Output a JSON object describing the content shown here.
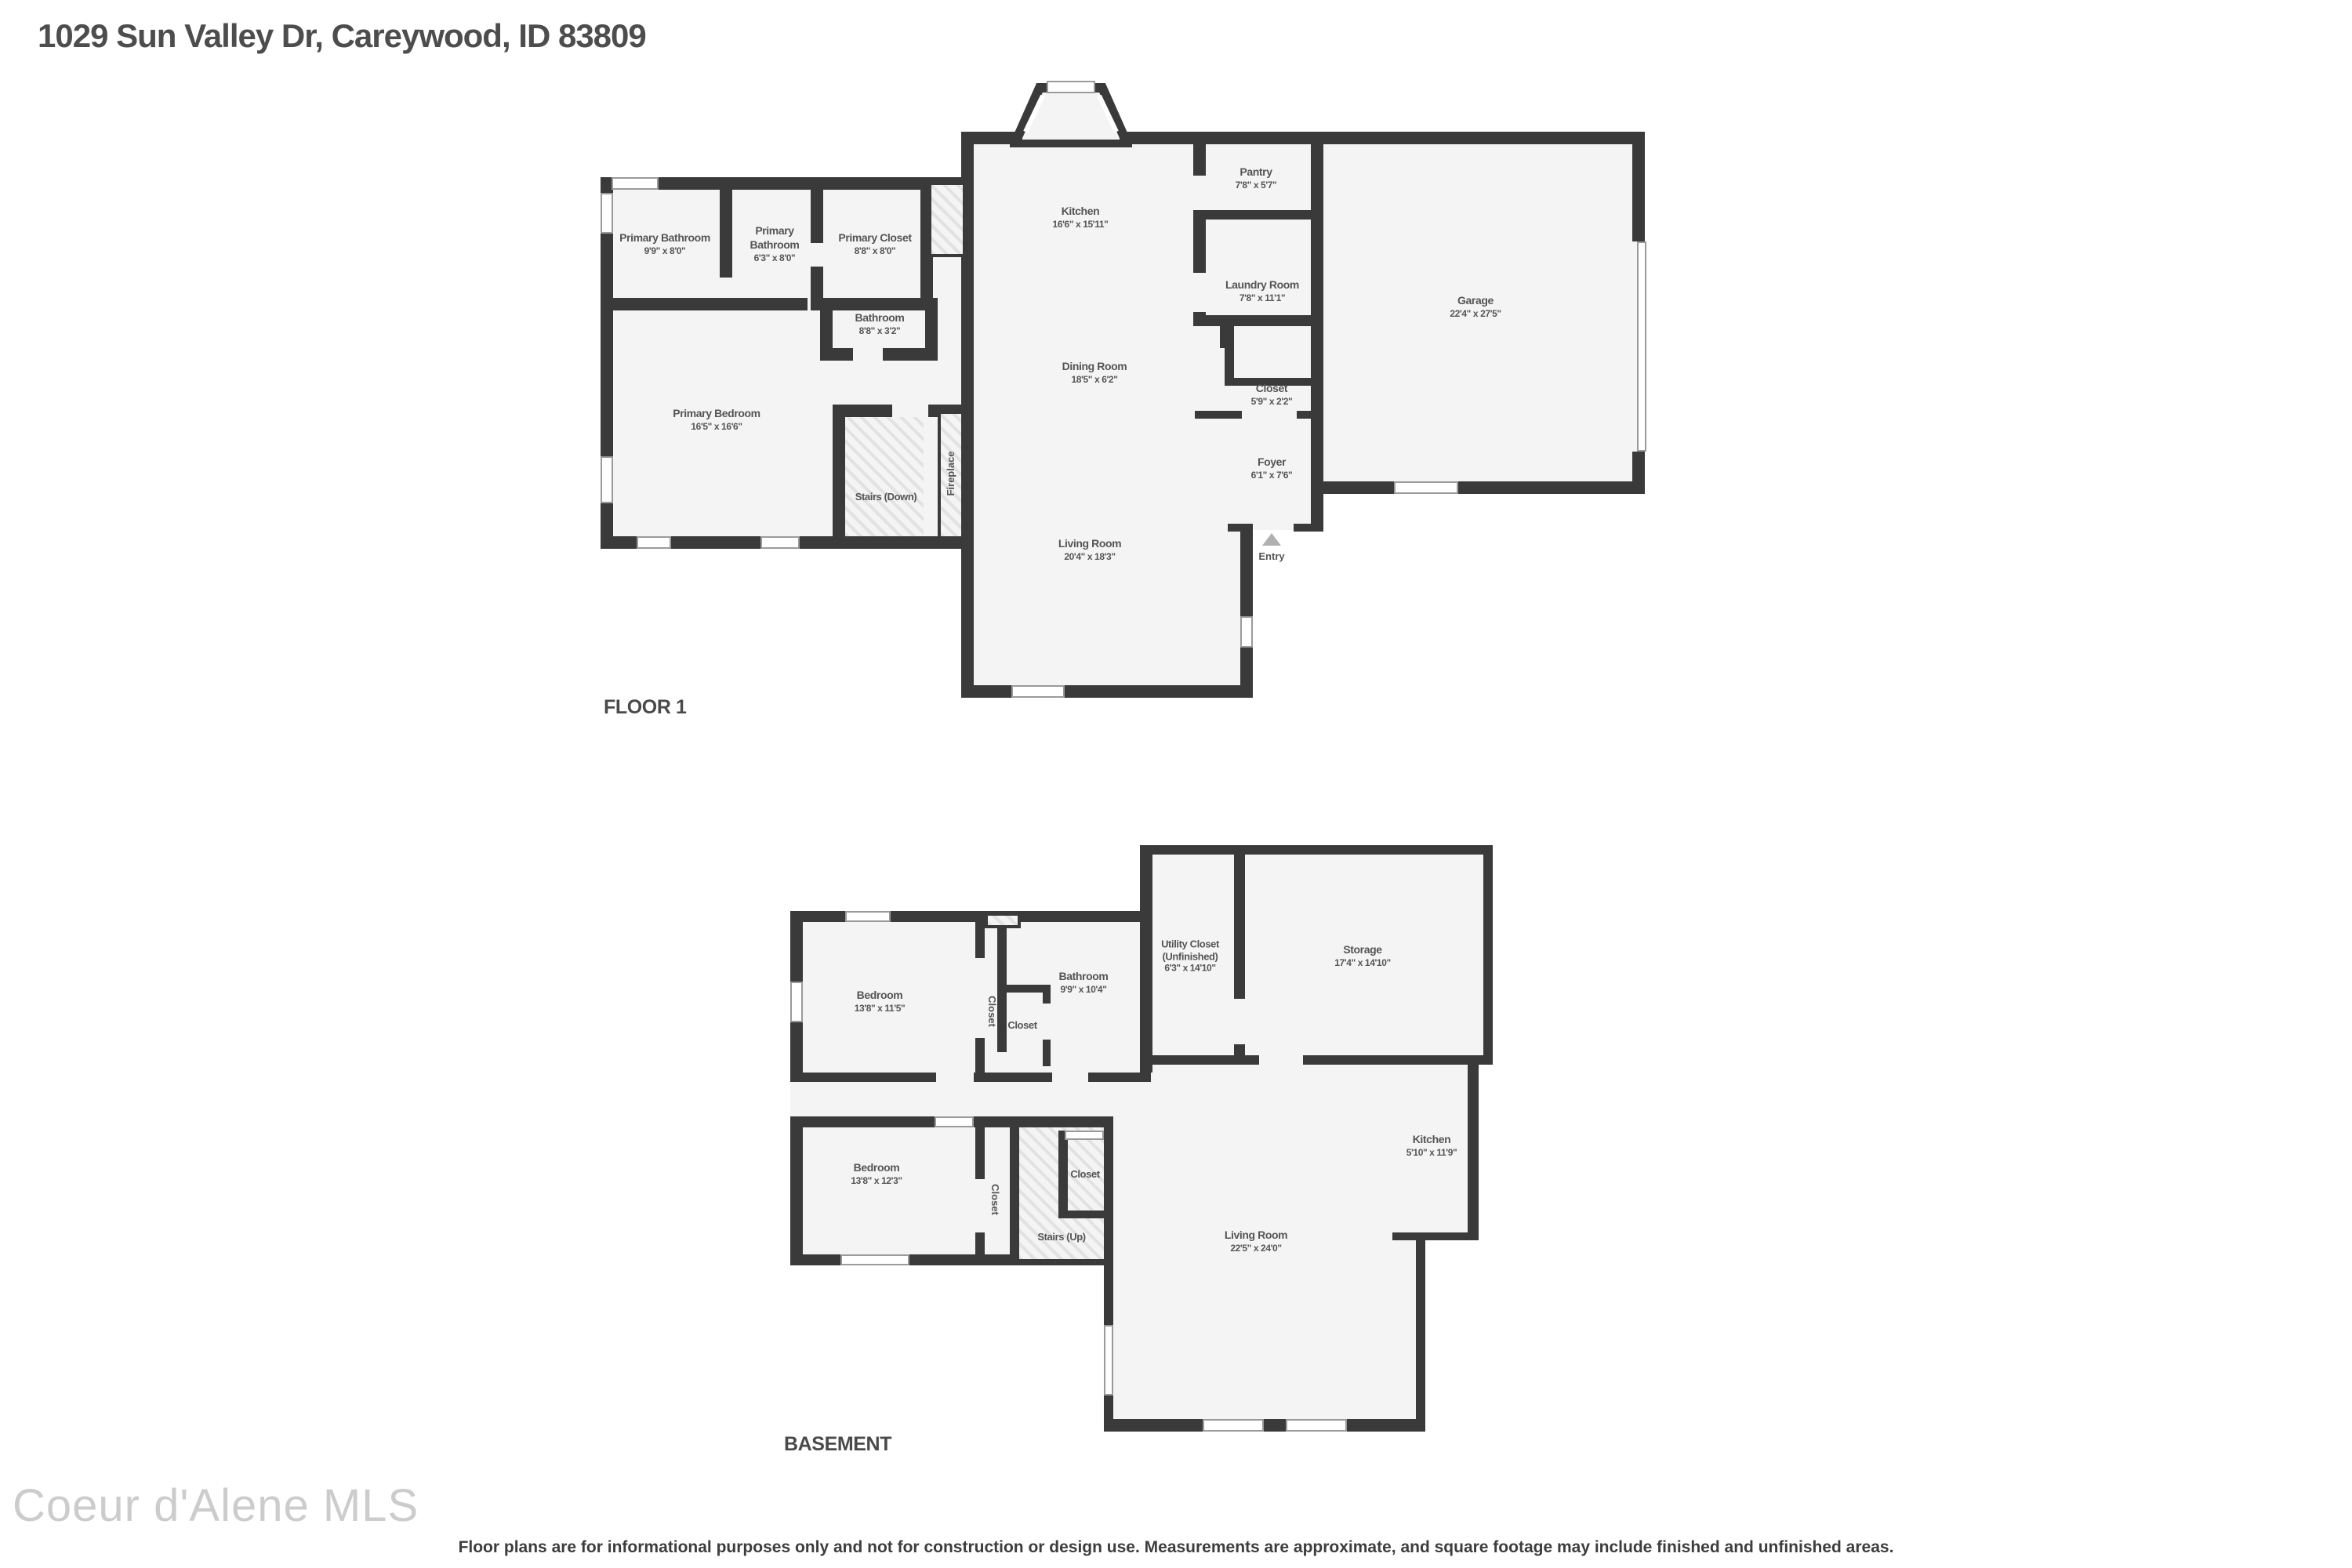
{
  "page": {
    "title": "1029 Sun Valley Dr, Careywood, ID 83809",
    "watermark": "Coeur d'Alene MLS",
    "disclaimer": "Floor plans are for informational purposes only and not for construction or design use. Measurements are approximate, and square footage may include finished and unfinished areas."
  },
  "floor1": {
    "label": "FLOOR 1",
    "rooms": {
      "primary_bathroom_1": {
        "name": "Primary Bathroom",
        "dims": "9'9\" x 8'0\""
      },
      "primary_bathroom_2": {
        "name": "Primary Bathroom",
        "dims": "6'3\" x 8'0\""
      },
      "primary_closet": {
        "name": "Primary Closet",
        "dims": "8'8\" x 8'0\""
      },
      "bathroom": {
        "name": "Bathroom",
        "dims": "8'8\" x 3'2\""
      },
      "kitchen": {
        "name": "Kitchen",
        "dims": "16'6\" x 15'11\""
      },
      "pantry": {
        "name": "Pantry",
        "dims": "7'8\" x 5'7\""
      },
      "laundry": {
        "name": "Laundry Room",
        "dims": "7'8\" x 11'1\""
      },
      "garage": {
        "name": "Garage",
        "dims": "22'4\" x 27'5\""
      },
      "dining": {
        "name": "Dining Room",
        "dims": "18'5\" x 6'2\""
      },
      "closet": {
        "name": "Closet",
        "dims": "5'9\" x 2'2\""
      },
      "foyer": {
        "name": "Foyer",
        "dims": "6'1\" x 7'6\""
      },
      "primary_bedroom": {
        "name": "Primary Bedroom",
        "dims": "16'5\" x 16'6\""
      },
      "stairs_down": {
        "name": "Stairs (Down)"
      },
      "fireplace": {
        "name": "Fireplace"
      },
      "living": {
        "name": "Living Room",
        "dims": "20'4\" x 18'3\""
      },
      "entry": {
        "name": "Entry"
      }
    }
  },
  "basement": {
    "label": "BASEMENT",
    "rooms": {
      "bedroom1": {
        "name": "Bedroom",
        "dims": "13'8\" x 11'5\""
      },
      "closet_hall": {
        "name": "Closet"
      },
      "closet_bath": {
        "name": "Closet"
      },
      "bathroom": {
        "name": "Bathroom",
        "dims": "9'9\" x 10'4\""
      },
      "utility": {
        "name": "Utility Closet",
        "name2": "(Unfinished)",
        "dims": "6'3\" x 14'10\""
      },
      "storage": {
        "name": "Storage",
        "dims": "17'4\" x 14'10\""
      },
      "bedroom2": {
        "name": "Bedroom",
        "dims": "13'8\" x 12'3\""
      },
      "closet_hall2": {
        "name": "Closet"
      },
      "closet_stairs": {
        "name": "Closet"
      },
      "stairs_up": {
        "name": "Stairs (Up)"
      },
      "kitchen": {
        "name": "Kitchen",
        "dims": "5'10\" x 11'9\""
      },
      "living": {
        "name": "Living Room",
        "dims": "22'5\" x 24'0\""
      }
    }
  }
}
